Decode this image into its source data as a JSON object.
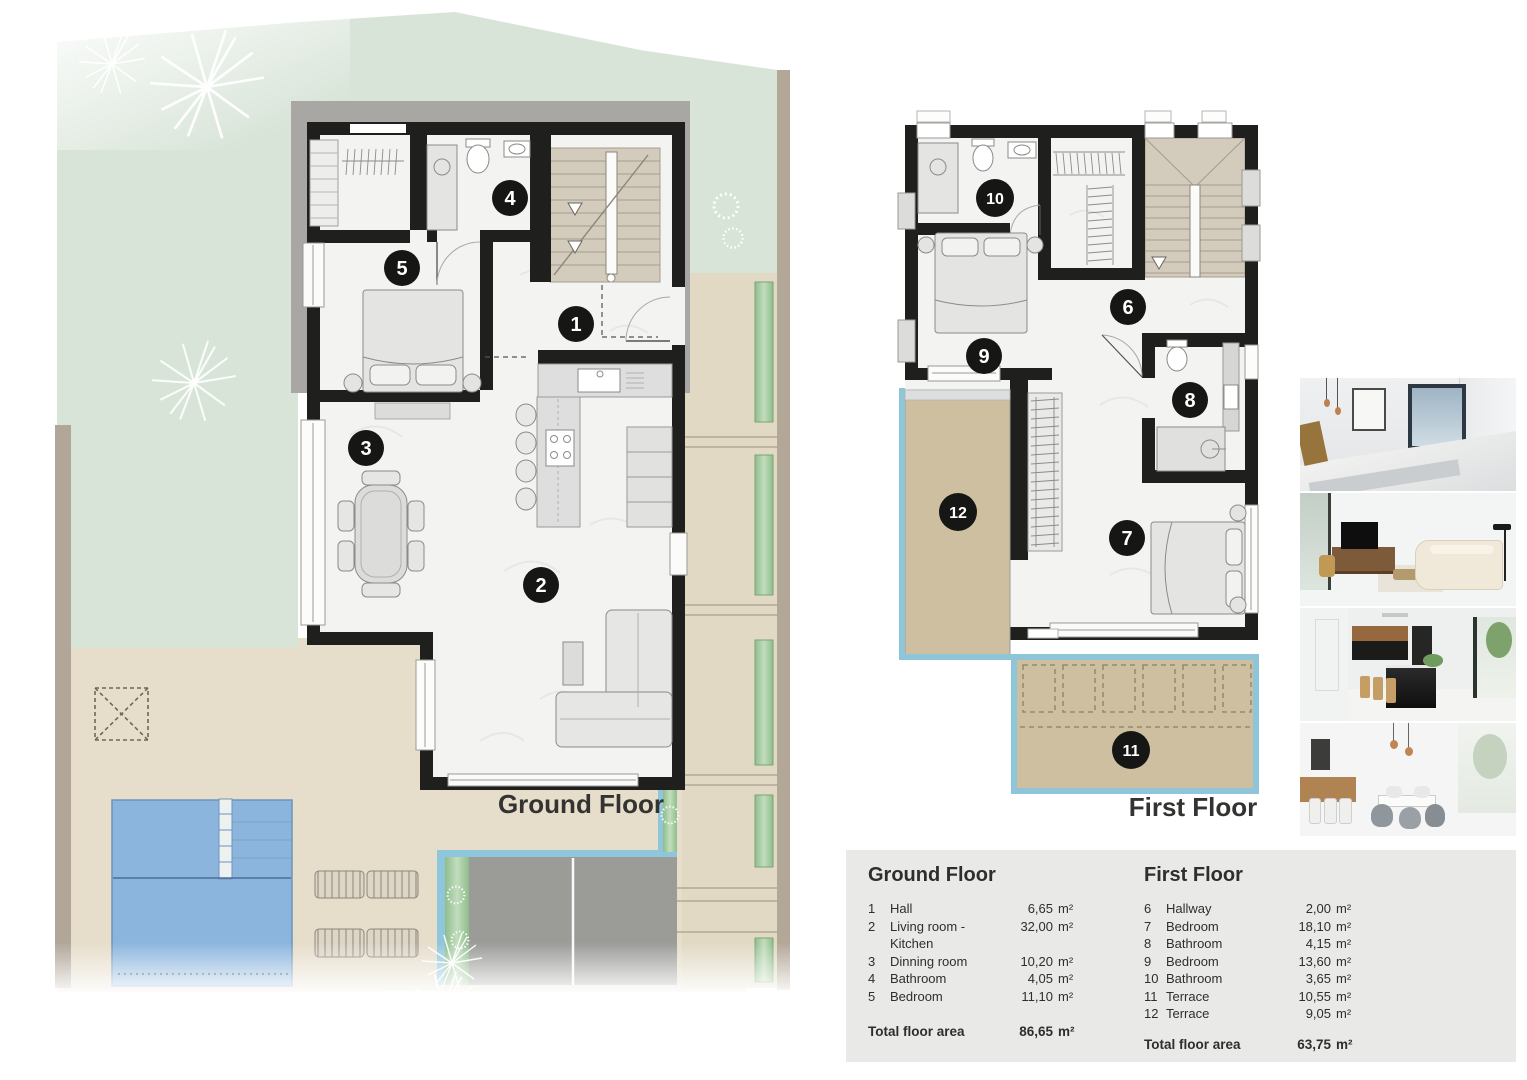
{
  "plan_labels": {
    "ground": "Ground Floor",
    "first": "First Floor"
  },
  "markers": {
    "1": "1",
    "2": "2",
    "3": "3",
    "4": "4",
    "5": "5",
    "6": "6",
    "7": "7",
    "8": "8",
    "9": "9",
    "10": "10",
    "11": "11",
    "12": "12"
  },
  "legend": {
    "unit": "m²",
    "ground": {
      "title": "Ground Floor",
      "rows": [
        {
          "num": "1",
          "name": "Hall",
          "area": "6,65"
        },
        {
          "num": "2",
          "name": "Living room - Kitchen",
          "area": "32,00"
        },
        {
          "num": "3",
          "name": "Dinning room",
          "area": "10,20"
        },
        {
          "num": "4",
          "name": "Bathroom",
          "area": "4,05"
        },
        {
          "num": "5",
          "name": "Bedroom",
          "area": "11,10"
        }
      ],
      "total_label": "Total floor area",
      "total_area": "86,65"
    },
    "first": {
      "title": "First Floor",
      "rows": [
        {
          "num": "6",
          "name": "Hallway",
          "area": "2,00"
        },
        {
          "num": "7",
          "name": "Bedroom",
          "area": "18,10"
        },
        {
          "num": "8",
          "name": "Bathroom",
          "area": "4,15"
        },
        {
          "num": "9",
          "name": "Bedroom",
          "area": "13,60"
        },
        {
          "num": "10",
          "name": "Bathroom",
          "area": "3,65"
        },
        {
          "num": "11",
          "name": "Terrace",
          "area": "10,55"
        },
        {
          "num": "12",
          "name": "Terrace",
          "area": "9,05"
        }
      ],
      "total_label": "Total floor area",
      "total_area": "63,75"
    }
  },
  "photos": [
    {
      "name": "bedroom render"
    },
    {
      "name": "living room render"
    },
    {
      "name": "kitchen render"
    },
    {
      "name": "dining room render"
    }
  ],
  "colors": {
    "wall": "#1f1f1d",
    "garden": "#d8e4d8",
    "patio": "#e6ddca",
    "terrace": "#cdbfa0",
    "pool": "#8cb5de",
    "terrace_edge": "#8fc5d8",
    "stairs": "#d3cbbc",
    "legend_bg": "#e9e9e7"
  }
}
